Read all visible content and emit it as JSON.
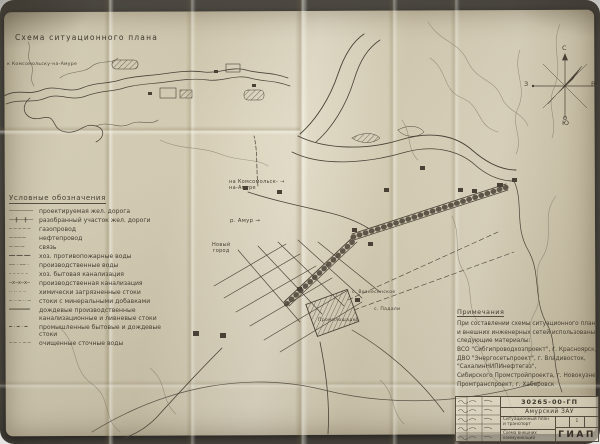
{
  "inset": {
    "title": "Схема ситуационного плана",
    "route_label": "к Комсомольску-на-Амуре"
  },
  "legend": {
    "title": "Условные обозначения",
    "items": [
      {
        "symbol": "────────",
        "label": "проектируемая жел. дорога"
      },
      {
        "symbol": "──╫──╫──",
        "label": "разобранный участок жел. дороги"
      },
      {
        "symbol": "─ ─ ─ ─ ─",
        "label": "газопровод"
      },
      {
        "symbol": "─·─·─·─",
        "label": "нефтепровод"
      },
      {
        "symbol": "─··─··─",
        "label": "связь"
      },
      {
        "symbol": "━━ ━━ ━━",
        "label": "хоз. противопожарные воды"
      },
      {
        "symbol": "── · ── ·",
        "label": "производственные воды"
      },
      {
        "symbol": "– – – – –",
        "label": "хоз. бытовая канализация"
      },
      {
        "symbol": "─x─x─x─",
        "label": "производственная канализация"
      },
      {
        "symbol": "·· ·· ·· ··",
        "label": "химически загрязненные стоки"
      },
      {
        "symbol": "─ ·· ─ ·· ─",
        "label": "стоки с минеральными добавками"
      },
      {
        "symbol": "═══════",
        "label": "дождевые производственные канализационные и ливневые стоки"
      },
      {
        "symbol": "━ · ━ · ━",
        "label": "промышленные бытовые и дождевые стоки"
      },
      {
        "symbol": "─ ─ ·· ─ ─",
        "label": "очищенные сточные воды"
      }
    ]
  },
  "map": {
    "labels": {
      "route1": "на Комсомольск-",
      "route2": "на-Амуре",
      "route_arrow": "→",
      "river": "р. Амур",
      "river_arrow": "→",
      "city1": "Новый",
      "city2": "город",
      "plant": "Промплощадка",
      "village_a": "с. Вознесенское",
      "village_b": "с. Падали"
    }
  },
  "compass": {
    "north": "С",
    "south": "Ю",
    "east": "В",
    "west": "З"
  },
  "notes": {
    "title": "Примечания",
    "lines": [
      "При составлении схемы ситуационного плана",
      "и внешних инженерных сетей использованы",
      "следующие материалы:",
      "ВСО \"Сибгипроводхозпроект\", г. Красноярск,",
      "ДВО \"Энергосетьпроект\", г. Владивосток,",
      "\"СахалинНИПИнефтегаз\",",
      "Сибирского Промстройпроекта, г. Новокузнецк,",
      "Промтранспроект, г. Хабаровск"
    ]
  },
  "stamp": {
    "doc_number": "30265-00-ГП",
    "project": "Амурский ЗАУ",
    "sheet_title_1": "Ситуационный план и транспорт",
    "sheet_subtitle": "Схема внешних коммуникаций",
    "sheet_no": "1",
    "org": "ГИАП"
  },
  "colors": {
    "paper": "#d8d0b7",
    "ink": "#4a4136",
    "contour": "#7b7260"
  }
}
